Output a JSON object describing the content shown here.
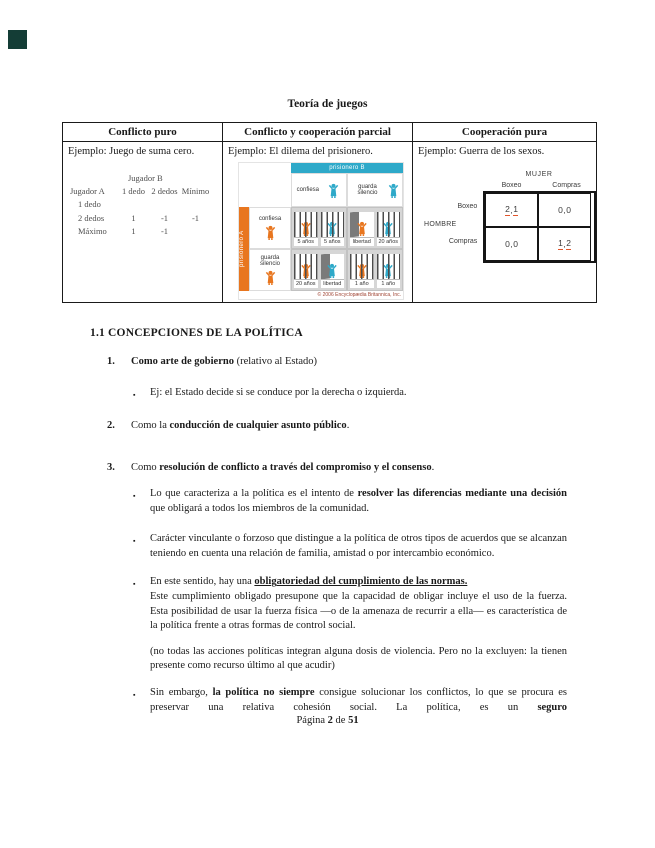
{
  "colors": {
    "teal": "#2ea9c9",
    "orange": "#e8761f",
    "underline": "#e2552b",
    "corner": "#143d36",
    "text": "#1a1a1a"
  },
  "bullet_glyph": "▪",
  "page": {
    "title": "Teoría de juegos",
    "footer": {
      "part1": "Página ",
      "page_num": "2",
      "part2": " de ",
      "total": "51"
    }
  },
  "table": {
    "headers": [
      "Conflicto puro",
      "Conflicto y cooperación parcial",
      "Cooperación pura"
    ],
    "examples": [
      "Ejemplo: Juego de suma cero.",
      "Ejemplo: El dilema del prisionero.",
      "Ejemplo: Guerra de los sexos."
    ]
  },
  "zero_sum": {
    "col_player": "Jugador B",
    "row_player": "Jugador A",
    "col_headers": [
      "1 dedo",
      "2 dedos",
      "Mínimo"
    ],
    "rows": [
      {
        "label": "1 dedo",
        "v1": "",
        "v2": "",
        "v3": ""
      },
      {
        "label": "2 dedos",
        "v1": "1",
        "v2": "-1",
        "v3": "-1"
      },
      {
        "label": "Máximo",
        "v1": "1",
        "v2": "-1",
        "v3": ""
      }
    ]
  },
  "prisoners": {
    "col_player": "prisionero B",
    "row_player": "prisionero A",
    "col_labels": [
      "confiesa",
      "guarda silencio"
    ],
    "row_labels": [
      "confiesa",
      "guarda silencio"
    ],
    "quadrants": [
      {
        "left": "5 años",
        "right": "5 años"
      },
      {
        "left": "libertad",
        "right": "20 años"
      },
      {
        "left": "20 años",
        "right": "libertad"
      },
      {
        "left": "1 año",
        "right": "1 año"
      }
    ],
    "copyright": "© 2006 Encyclopædia Britannica, Inc."
  },
  "battle": {
    "col_group": "MUJER",
    "row_group": "HOMBRE",
    "col_headers": [
      "Boxeo",
      "Compras"
    ],
    "row_headers": [
      "Boxeo",
      "Compras"
    ],
    "cells": [
      {
        "a": "2",
        "sep": " , ",
        "b": "1"
      },
      {
        "a": "0",
        "sep": " , ",
        "b": "0"
      },
      {
        "a": "0",
        "sep": " , ",
        "b": "0"
      },
      {
        "a": "1",
        "sep": " , ",
        "b": "2"
      }
    ]
  },
  "content": {
    "heading": "1.1 CONCEPCIONES DE LA POLÍTICA",
    "item1": {
      "num": "1.",
      "bold": "Como arte de gobierno",
      "rest": " (relativo al Estado)",
      "bullet": "Ej: el Estado decide si se conduce por la derecha o izquierda."
    },
    "item2": {
      "num": "2.",
      "pre": "Como la ",
      "bold": "conducción de cualquier asunto público",
      "post": "."
    },
    "item3": {
      "num": "3.",
      "pre": "Como ",
      "bold": "resolución de conflicto a través del compromiso y el consenso",
      "post": "."
    },
    "b3a": {
      "pre": "Lo que caracteriza a la política es el intento de ",
      "bold": "resolver las diferencias mediante una decisión",
      "post": " que obligará a todos los miembros de la comunidad."
    },
    "b3b": {
      "text": "Carácter vinculante o forzoso que distingue a la política de otros tipos de acuerdos que se alcanzan teniendo en cuenta una relación de familia, amistad o por intercambio económico."
    },
    "b3c": {
      "pre": "En este sentido, hay una ",
      "bold_u": "obligatoriedad del cumplimiento de las normas.",
      "rest": "Este cumplimiento obligado presupone que la capacidad de obligar incluye el uso de la fuerza. Esta posibilidad de usar la fuerza física —o de la amenaza de recurrir a ella— es característica de la política frente a otras formas de control social."
    },
    "paren": {
      "text": "(no todas las acciones políticas integran alguna dosis de violencia. Pero no la excluyen: la tienen presente como recurso último al que acudir)"
    },
    "b3d": {
      "pre": "Sin embargo, ",
      "bold": "la política no siempre",
      "mid": " consigue solucionar los conflictos, lo que se procura es preservar una relativa cohesión social. La política, es un ",
      "bold2": "seguro"
    }
  }
}
